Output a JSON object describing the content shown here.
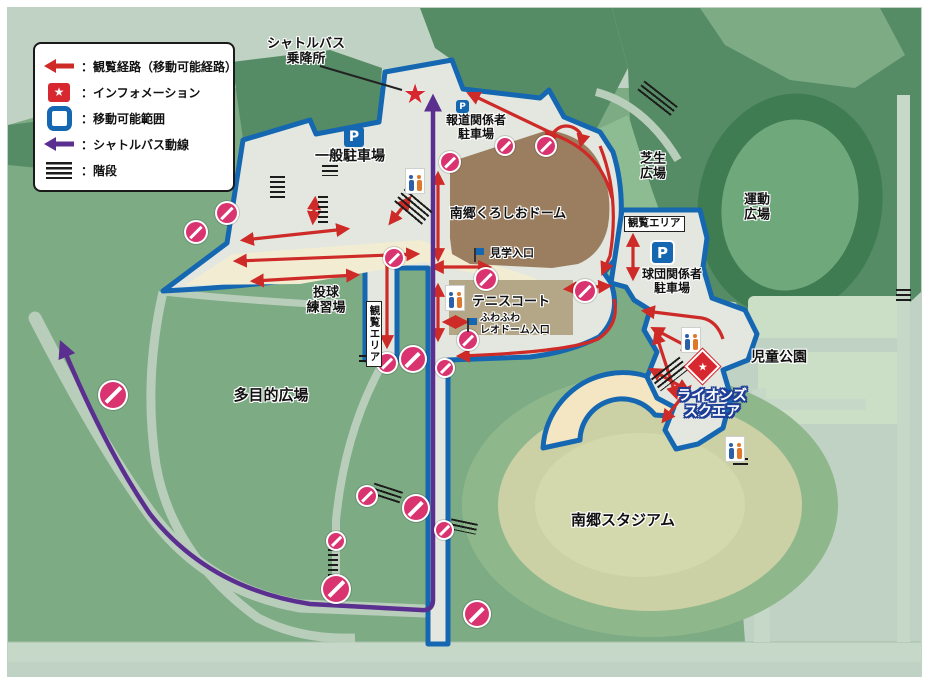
{
  "title": "南郷スポーツ施設 観覧経路マップ",
  "colors": {
    "background": "#c0d2c3",
    "land_green": "#7cab84",
    "forest_green": "#558c66",
    "walkable_gray": "#e3e7df",
    "boundary_blue": "#1467b0",
    "route_purple": "#5b2f90",
    "viewing_route_red": "#ce2a28",
    "no_entry_pink": "#d9346f",
    "information_red": "#d7282f",
    "dome_brown": "#9b7e60",
    "tennis_tan": "#b3a787",
    "stadium_field": "#cbd1a5",
    "lions_text_outline": "#1d3f97"
  },
  "legend": {
    "items": [
      {
        "icon": "viewing-route-arrow-icon",
        "label": "：観覧経路（移動可能経路）"
      },
      {
        "icon": "information-star-icon",
        "label": "：インフォメーション"
      },
      {
        "icon": "movable-range-icon",
        "label": "：移動可能範囲"
      },
      {
        "icon": "shuttle-bus-route-arrow-icon",
        "label": "：シャトルバス動線"
      },
      {
        "icon": "stairs-icon",
        "label": "：階段"
      }
    ]
  },
  "icons": {
    "star_glyph": "★"
  },
  "regions": {
    "shuttle_stop_line1": "シャトルバス",
    "shuttle_stop_line2": "乗降所",
    "general_parking": "一般駐車場",
    "press_parking_line1": "報道関係者",
    "press_parking_line2": "駐車場",
    "dome": "南郷くろしおドーム",
    "tour_entrance": "見学入口",
    "tennis_court": "テニスコート",
    "fuwafuwa_line1": "ふわふわ",
    "fuwafuwa_line2": "レオドーム入口",
    "pitching_line1": "投球",
    "pitching_line2": "練習場",
    "viewing_area_left": "観覧エリア",
    "multipurpose_plaza": "多目的広場",
    "lawn_plaza_line1": "芝生",
    "lawn_plaza_line2": "広場",
    "sports_plaza_line1": "運動",
    "sports_plaza_line2": "広場",
    "viewing_area_right": "観覧エリア",
    "team_parking_line1": "球団関係者",
    "team_parking_line2": "駐車場",
    "children_park": "児童公園",
    "lions_square_line1": "ライオンズ",
    "lions_square_line2": "スクエア",
    "stadium": "南郷スタジアム",
    "parking_letter": "P"
  },
  "map_icons": {
    "no_entry": [
      [
        227,
        213,
        10
      ],
      [
        196,
        232,
        10
      ],
      [
        113,
        395,
        13
      ],
      [
        450,
        162,
        9
      ],
      [
        505,
        146,
        8
      ],
      [
        394,
        258,
        9
      ],
      [
        486,
        279,
        10
      ],
      [
        585,
        291,
        10
      ],
      [
        546,
        146,
        9
      ],
      [
        468,
        340,
        9
      ],
      [
        387,
        363,
        9
      ],
      [
        413,
        359,
        12
      ],
      [
        445,
        368,
        8
      ],
      [
        367,
        496,
        9
      ],
      [
        416,
        508,
        12
      ],
      [
        444,
        530,
        8
      ],
      [
        336,
        541,
        8
      ],
      [
        336,
        589,
        13
      ],
      [
        477,
        614,
        12
      ]
    ],
    "restroom": [
      [
        415,
        180
      ],
      [
        455,
        297
      ],
      [
        691,
        339
      ],
      [
        735,
        448
      ]
    ],
    "stairs": [
      [
        270,
        176,
        15,
        22,
        0
      ],
      [
        318,
        196,
        10,
        28,
        0
      ],
      [
        322,
        165,
        16,
        11,
        0
      ],
      [
        395,
        198,
        36,
        18,
        40
      ],
      [
        636,
        92,
        42,
        14,
        38
      ],
      [
        733,
        458,
        15,
        10,
        0
      ],
      [
        896,
        289,
        15,
        12,
        0
      ],
      [
        652,
        366,
        36,
        16,
        -38
      ],
      [
        328,
        544,
        10,
        36,
        0
      ],
      [
        372,
        487,
        30,
        12,
        18
      ],
      [
        450,
        521,
        27,
        11,
        12
      ],
      [
        359,
        355,
        17,
        10,
        0
      ]
    ]
  }
}
